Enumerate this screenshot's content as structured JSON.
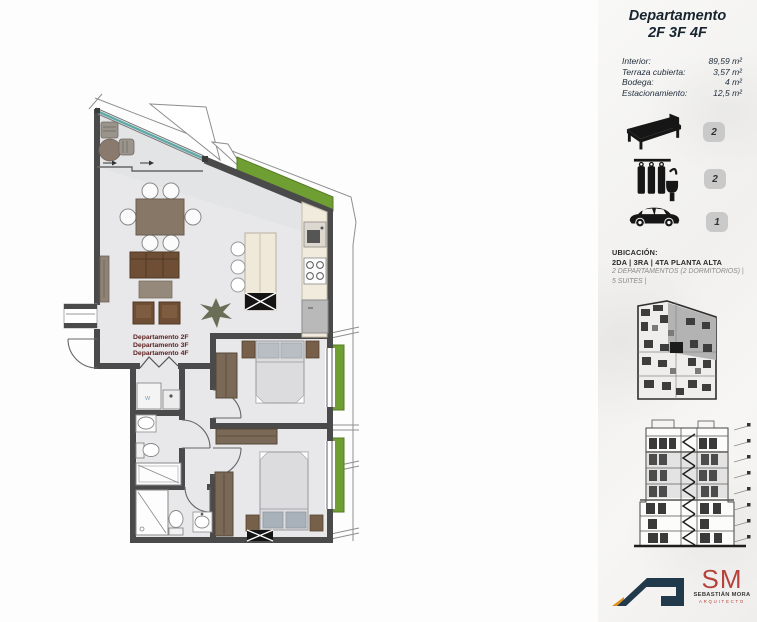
{
  "panel": {
    "title": {
      "line1": "Departamento",
      "line2": "2F 3F 4F"
    },
    "specs": [
      {
        "label": "Interior:",
        "value": "89,59 m²"
      },
      {
        "label": "Terraza cubierta:",
        "value": "3,57 m²"
      },
      {
        "label": "Bodega:",
        "value": "4 m²"
      },
      {
        "label": "Estacionamiento:",
        "value": "12,5 m²"
      }
    ],
    "amenities": [
      {
        "name": "bedrooms",
        "icon": "bed-icon",
        "count": "2"
      },
      {
        "name": "bathrooms",
        "icon": "shower-icon",
        "count": "2"
      },
      {
        "name": "parking",
        "icon": "car-icon",
        "count": "1"
      }
    ],
    "ubicacion": {
      "heading": "UBICACIÓN:",
      "floors": "2DA | 3RA | 4TA PLANTA ALTA",
      "detail1": "2 DEPARTAMENTOS (2 DORMITORIOS) |",
      "detail2": "5 SUITES |"
    },
    "logos": {
      "architect_initials": "SM",
      "architect_name": "SEBASTIÁN MORA",
      "architect_role": "ARQUITECTO"
    }
  },
  "plan": {
    "unit_labels": [
      "Departamento 2F",
      "Departamento 3F",
      "Departamento 4F"
    ],
    "washer_label": "W"
  },
  "colors": {
    "wall": "#4a4a4a",
    "floor": "#e8e8ea",
    "glass": "#5fa9a6",
    "green": "#6f9f33",
    "wood": "#6e4f35",
    "label_red": "#5d2121",
    "badge": "#c9c9c9",
    "navy": "#203a4c",
    "orange": "#e2901d",
    "sm_red": "#b5433c"
  }
}
